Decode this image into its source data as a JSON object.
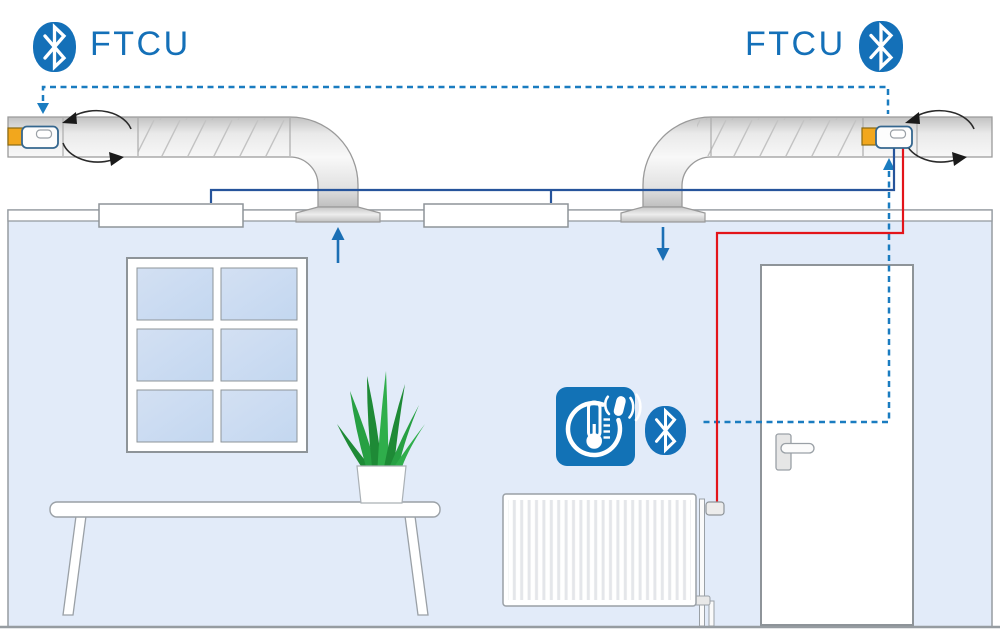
{
  "diagram": {
    "title": "FTCU Bluetooth duct fan installation in a room",
    "left_unit_label": "FTCU",
    "right_unit_label": "FTCU"
  },
  "icons": {
    "bluetooth_left": "bluetooth-icon",
    "bluetooth_right": "bluetooth-icon",
    "bluetooth_room": "bluetooth-icon",
    "thermostat_room": "thermostat-radio-icon",
    "rotation_arrows": "rotation-arrow-icon",
    "airflow_up": "arrow-up-icon",
    "airflow_down": "arrow-down-icon",
    "dashed_link": "wireless-link-dashed-line"
  },
  "colors": {
    "bluetooth_blue": "#1470b8",
    "label_blue": "#1470b8",
    "dashed_link_blue": "#1a7cc0",
    "airflow_arrow_blue": "#1b6fb5",
    "control_wire_blue": "#26549b",
    "heating_wire_red": "#e3141a",
    "device_accent_orange": "#f2a71d",
    "room_wall_fill": "#e2ebf9",
    "window_pane_fill": "#cfdef2",
    "duct_gray": "#e3e3e3",
    "outline_gray": "#969ca1",
    "plant_green": "#27a043"
  }
}
